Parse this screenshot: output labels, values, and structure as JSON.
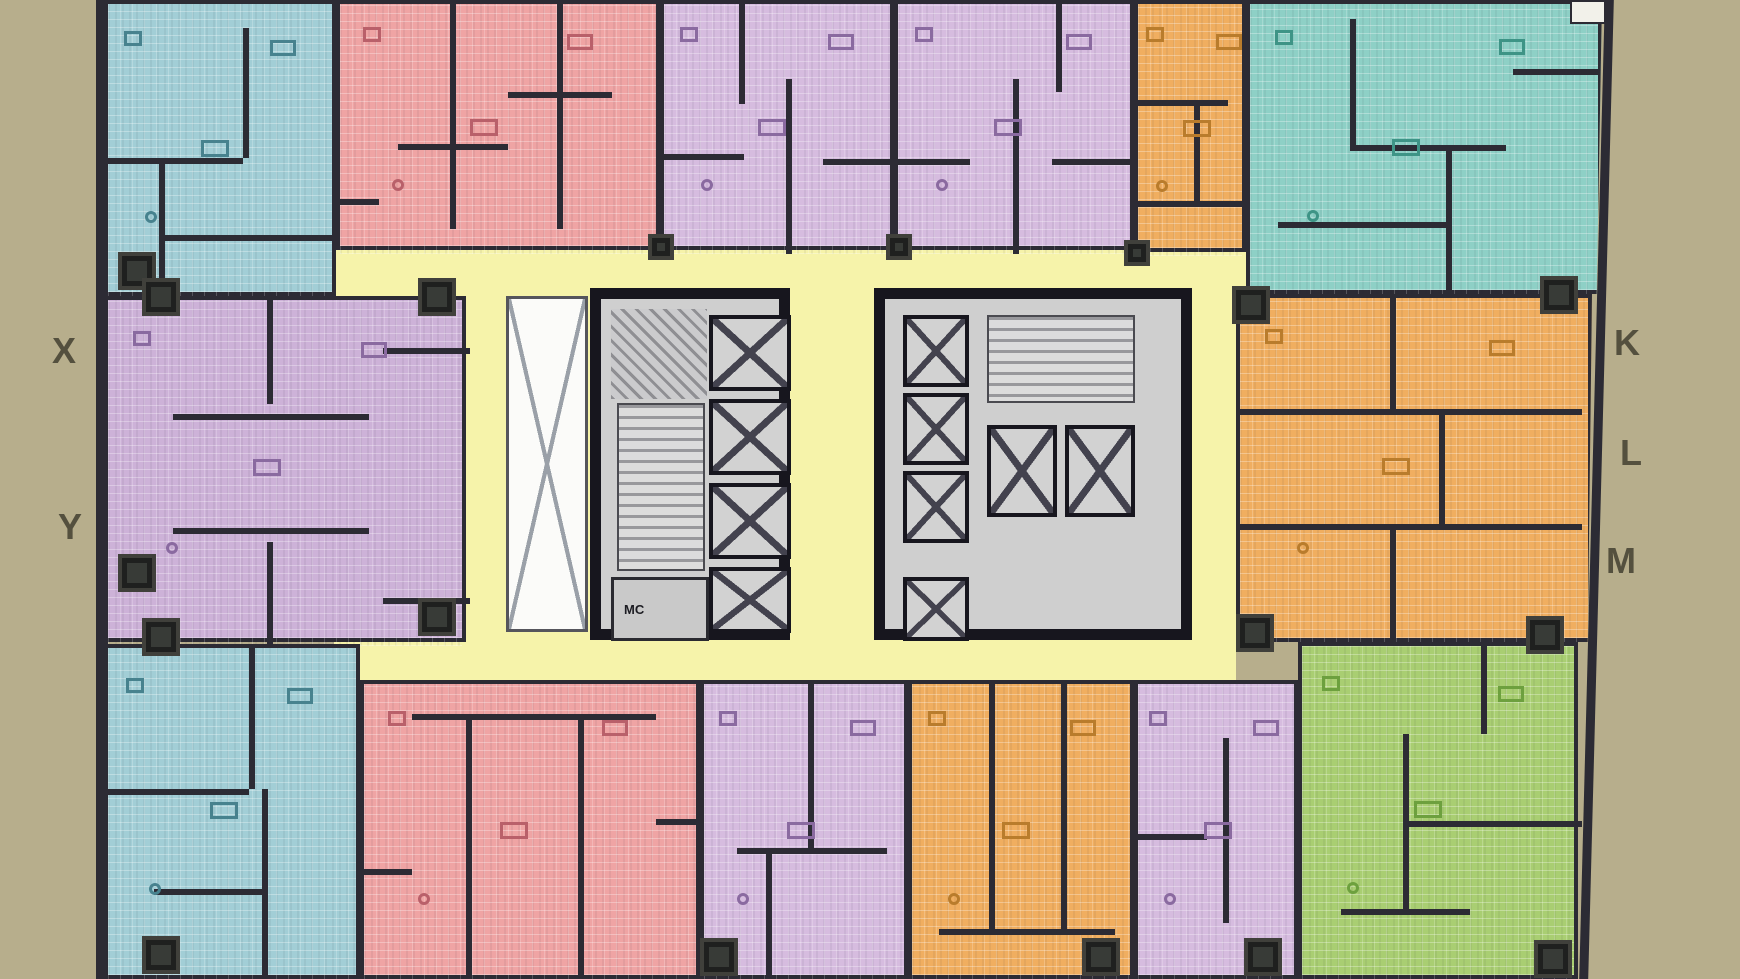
{
  "plan_type": "residential-tower-typical-floor-plan",
  "palette": {
    "tan": "#b7ae8c",
    "corridor_yellow": "#f6f3aa",
    "wall_dark": "#2c2b34",
    "core_gray": "#cfcfcf",
    "shaft_white": "#fbfbf9",
    "letter_color": "#54503e",
    "pink": "#efa4a4",
    "purple": "#d6bcdf",
    "purple_deep": "#cdb2d8",
    "teal": "#a2ced6",
    "teal_mint": "#8ed0c6",
    "orange": "#f0ae60",
    "green": "#a9ce72",
    "accent_pink": "#b9606a",
    "accent_purple": "#8a6aa0",
    "accent_teal": "#47828e",
    "accent_teal_mint": "#3e9486",
    "accent_orange": "#b97c2c",
    "accent_green": "#6da03e"
  },
  "grid_labels": [
    {
      "text": "X",
      "x": 52,
      "y": 330
    },
    {
      "text": "Y",
      "x": 58,
      "y": 506
    },
    {
      "text": "K",
      "x": 1614,
      "y": 322
    },
    {
      "text": "L",
      "x": 1620,
      "y": 432
    },
    {
      "text": "M",
      "x": 1606,
      "y": 540
    }
  ],
  "corridors": [
    [
      334,
      246,
      1028,
      56
    ],
    [
      464,
      298,
      772,
      340
    ],
    [
      334,
      632,
      902,
      52
    ]
  ],
  "units": [
    {
      "id": "teal-top-left",
      "color": "teal",
      "accent": "accent_teal",
      "rect": [
        104,
        0,
        232,
        296
      ],
      "walls": [
        [
          0.58,
          0.08,
          0.58,
          0.52
        ],
        [
          0,
          0.52,
          0.58,
          0.52
        ],
        [
          0.22,
          0.52,
          0.22,
          1
        ],
        [
          0.22,
          0.78,
          1,
          0.78
        ]
      ]
    },
    {
      "id": "pink-top",
      "color": "pink",
      "accent": "accent_pink",
      "rect": [
        336,
        0,
        324,
        250
      ],
      "walls": [
        [
          0.34,
          0,
          0.34,
          0.9
        ],
        [
          0.67,
          0,
          0.67,
          0.9
        ],
        [
          0.18,
          0.56,
          0.52,
          0.56
        ],
        [
          0.52,
          0.35,
          0.84,
          0.35
        ],
        [
          0,
          0.78,
          0.12,
          0.78
        ]
      ]
    },
    {
      "id": "purple-top-a",
      "color": "purple",
      "accent": "accent_purple",
      "rect": [
        660,
        0,
        234,
        250
      ],
      "walls": [
        [
          0.32,
          0,
          0.32,
          0.4
        ],
        [
          0.52,
          0.3,
          0.52,
          1
        ],
        [
          0,
          0.6,
          0.34,
          0.6
        ],
        [
          0.68,
          0.62,
          1,
          0.62
        ]
      ]
    },
    {
      "id": "purple-top-b",
      "color": "purple",
      "accent": "accent_purple",
      "rect": [
        894,
        0,
        240,
        250
      ],
      "walls": [
        [
          0.48,
          0.3,
          0.48,
          1
        ],
        [
          0.66,
          0,
          0.66,
          0.35
        ],
        [
          0,
          0.62,
          0.3,
          0.62
        ],
        [
          0.64,
          0.62,
          1,
          0.62
        ]
      ]
    },
    {
      "id": "orange-top",
      "color": "orange",
      "accent": "accent_orange",
      "rect": [
        1134,
        0,
        112,
        252
      ],
      "walls": [
        [
          0,
          0.38,
          0.8,
          0.38
        ],
        [
          0.5,
          0.38,
          0.5,
          0.78
        ],
        [
          0,
          0.78,
          1,
          0.78
        ]
      ]
    },
    {
      "id": "teal-top-right",
      "color": "teal_mint",
      "accent": "accent_teal_mint",
      "rect": [
        1246,
        0,
        356,
        294
      ],
      "clip": "polygon(0 0, 100% 0, 98.5% 100%, 0 100%)",
      "walls": [
        [
          0.28,
          0.05,
          0.28,
          0.48
        ],
        [
          0.28,
          0.48,
          0.72,
          0.48
        ],
        [
          0.55,
          0.48,
          0.55,
          1
        ],
        [
          0.74,
          0.22,
          0.98,
          0.22
        ],
        [
          0.08,
          0.74,
          0.55,
          0.74
        ]
      ]
    },
    {
      "id": "purple-left-xy",
      "color": "purple_deep",
      "accent": "accent_purple",
      "rect": [
        104,
        296,
        362,
        346
      ],
      "walls": [
        [
          0.44,
          0,
          0.44,
          0.3
        ],
        [
          0.44,
          0.7,
          0.44,
          1
        ],
        [
          0.18,
          0.33,
          0.72,
          0.33
        ],
        [
          0.18,
          0.66,
          0.72,
          0.66
        ],
        [
          0.76,
          0.14,
          1,
          0.14
        ],
        [
          0.76,
          0.86,
          1,
          0.86
        ]
      ]
    },
    {
      "id": "orange-right-klm",
      "color": "orange",
      "accent": "accent_orange",
      "rect": [
        1236,
        294,
        356,
        348
      ],
      "clip": "polygon(0 0, 100% 0, 98.8% 100%, 0 100%)",
      "walls": [
        [
          0,
          0.32,
          0.96,
          0.32
        ],
        [
          0,
          0.65,
          0.96,
          0.65
        ],
        [
          0.42,
          0,
          0.42,
          0.32
        ],
        [
          0.56,
          0.32,
          0.56,
          0.65
        ],
        [
          0.42,
          0.65,
          0.42,
          1
        ]
      ]
    },
    {
      "id": "teal-bottom-left",
      "color": "teal",
      "accent": "accent_teal",
      "rect": [
        104,
        644,
        256,
        335
      ],
      "walls": [
        [
          0.55,
          0,
          0.55,
          0.42
        ],
        [
          0,
          0.42,
          0.55,
          0.42
        ],
        [
          0.6,
          0.42,
          0.6,
          1
        ],
        [
          0.18,
          0.72,
          0.6,
          0.72
        ]
      ]
    },
    {
      "id": "pink-bottom",
      "color": "pink",
      "accent": "accent_pink",
      "rect": [
        360,
        680,
        340,
        299
      ],
      "walls": [
        [
          0.3,
          0.1,
          0.3,
          1
        ],
        [
          0.63,
          0.1,
          0.63,
          1
        ],
        [
          0.14,
          0.1,
          0.86,
          0.1
        ],
        [
          0,
          0.62,
          0.14,
          0.62
        ],
        [
          0.86,
          0.45,
          1,
          0.45
        ]
      ]
    },
    {
      "id": "purple-bottom-a",
      "color": "purple",
      "accent": "accent_purple",
      "rect": [
        700,
        680,
        208,
        299
      ],
      "walls": [
        [
          0.5,
          0,
          0.5,
          0.55
        ],
        [
          0.16,
          0.55,
          0.88,
          0.55
        ],
        [
          0.3,
          0.55,
          0.3,
          1
        ]
      ]
    },
    {
      "id": "orange-bottom",
      "color": "orange",
      "accent": "accent_orange",
      "rect": [
        908,
        680,
        226,
        299
      ],
      "walls": [
        [
          0.34,
          0,
          0.34,
          0.82
        ],
        [
          0.66,
          0,
          0.66,
          0.82
        ],
        [
          0.12,
          0.82,
          0.9,
          0.82
        ]
      ]
    },
    {
      "id": "purple-bottom-b",
      "color": "purple",
      "accent": "accent_purple",
      "rect": [
        1134,
        680,
        164,
        299
      ],
      "walls": [
        [
          0.52,
          0.18,
          0.52,
          0.8
        ],
        [
          0,
          0.5,
          0.42,
          0.5
        ]
      ]
    },
    {
      "id": "green-bottom-right",
      "color": "green",
      "accent": "accent_green",
      "rect": [
        1298,
        642,
        280,
        337
      ],
      "walls": [
        [
          0.36,
          0.26,
          0.36,
          0.78
        ],
        [
          0.36,
          0.52,
          1,
          0.52
        ],
        [
          0.64,
          0,
          0.64,
          0.26
        ],
        [
          0.14,
          0.78,
          0.6,
          0.78
        ]
      ]
    }
  ],
  "cores": [
    {
      "name": "core-west",
      "rect": [
        590,
        288,
        200,
        352
      ],
      "lifts": [
        [
          108,
          16,
          82,
          76
        ],
        [
          108,
          100,
          82,
          76
        ],
        [
          108,
          184,
          82,
          76
        ],
        [
          108,
          268,
          82,
          66
        ]
      ],
      "stairs": [
        [
          16,
          104,
          88,
          168
        ]
      ],
      "diag": [
        [
          10,
          10,
          96,
          90
        ]
      ],
      "rooms": [
        {
          "x": 10,
          "y": 278,
          "w": 98,
          "h": 64,
          "label": "MC"
        }
      ]
    },
    {
      "name": "core-east",
      "rect": [
        874,
        288,
        318,
        352
      ],
      "lifts": [
        [
          18,
          16,
          66,
          72
        ],
        [
          18,
          94,
          66,
          72
        ],
        [
          18,
          172,
          66,
          72
        ],
        [
          18,
          278,
          66,
          64
        ],
        [
          102,
          126,
          70,
          92
        ],
        [
          180,
          126,
          70,
          92
        ]
      ],
      "stairs": [
        [
          102,
          16,
          148,
          88
        ]
      ],
      "diag": [],
      "rooms": []
    }
  ],
  "stair_shaft": {
    "rect": [
      506,
      296,
      82,
      336
    ]
  },
  "columns": [
    [
      118,
      252
    ],
    [
      418,
      278
    ],
    [
      118,
      554
    ],
    [
      418,
      598
    ],
    [
      1232,
      286
    ],
    [
      1540,
      276
    ],
    [
      1526,
      616
    ],
    [
      1236,
      614
    ],
    [
      142,
      278
    ],
    [
      142,
      618
    ],
    [
      142,
      936
    ],
    [
      1534,
      940
    ],
    [
      1244,
      938
    ],
    [
      700,
      938
    ],
    [
      1082,
      938
    ],
    [
      648,
      234,
      26
    ],
    [
      886,
      234,
      26
    ],
    [
      1124,
      240,
      26
    ]
  ],
  "edges": {
    "left_wall": [
      96,
      0,
      12,
      979
    ],
    "right_slant": {
      "left": 1592,
      "top": -6,
      "width": 9,
      "height": 992,
      "angle": 1.5
    },
    "top_right_notch": [
      1570,
      0,
      36,
      24
    ]
  }
}
